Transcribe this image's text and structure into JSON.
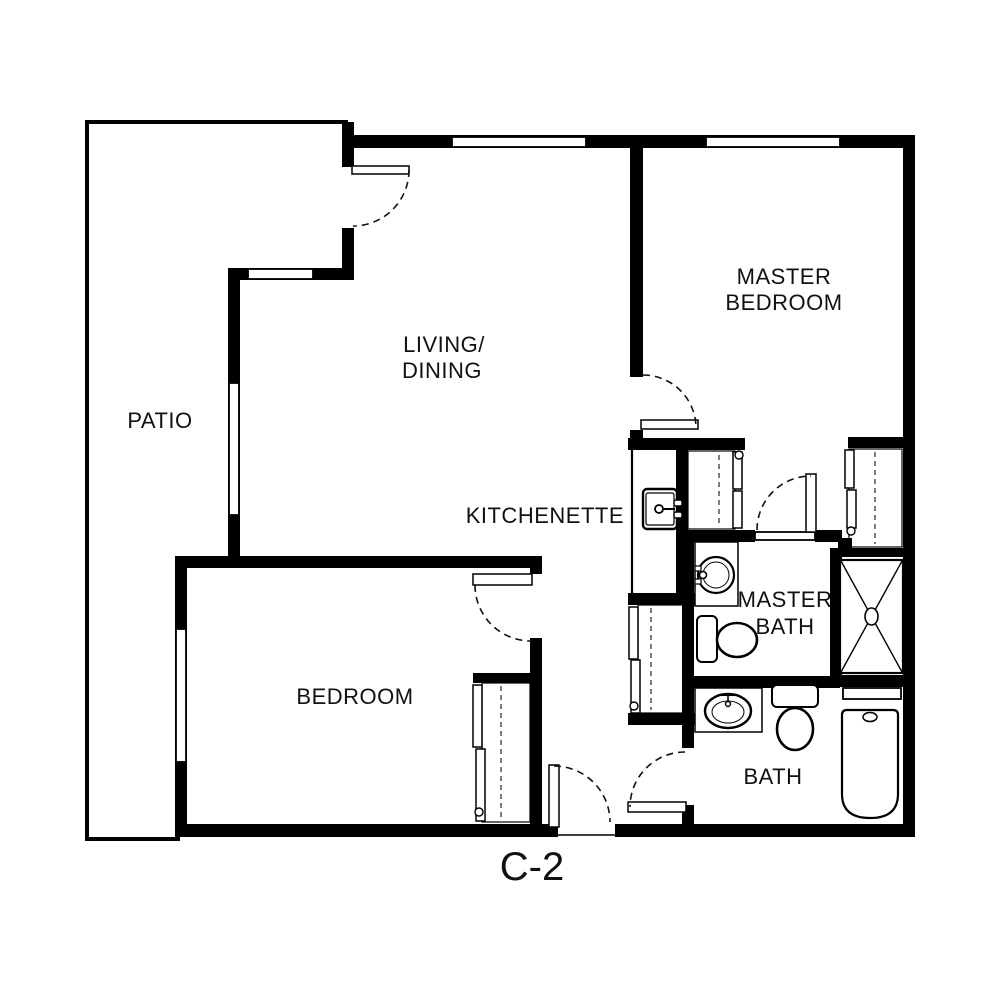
{
  "plan_title": "C-2",
  "rooms": {
    "patio": {
      "label": "PATIO"
    },
    "living_dining": {
      "line1": "LIVING/",
      "line2": "DINING"
    },
    "master_bedroom": {
      "line1": "MASTER",
      "line2": "BEDROOM"
    },
    "kitchenette": {
      "label": "KITCHENETTE"
    },
    "master_bath": {
      "line1": "MASTER",
      "line2": "BATH"
    },
    "bedroom": {
      "label": "BEDROOM"
    },
    "bath": {
      "label": "BATH"
    }
  },
  "colors": {
    "wall": "#000000",
    "background": "#ffffff",
    "text": "#111111"
  }
}
